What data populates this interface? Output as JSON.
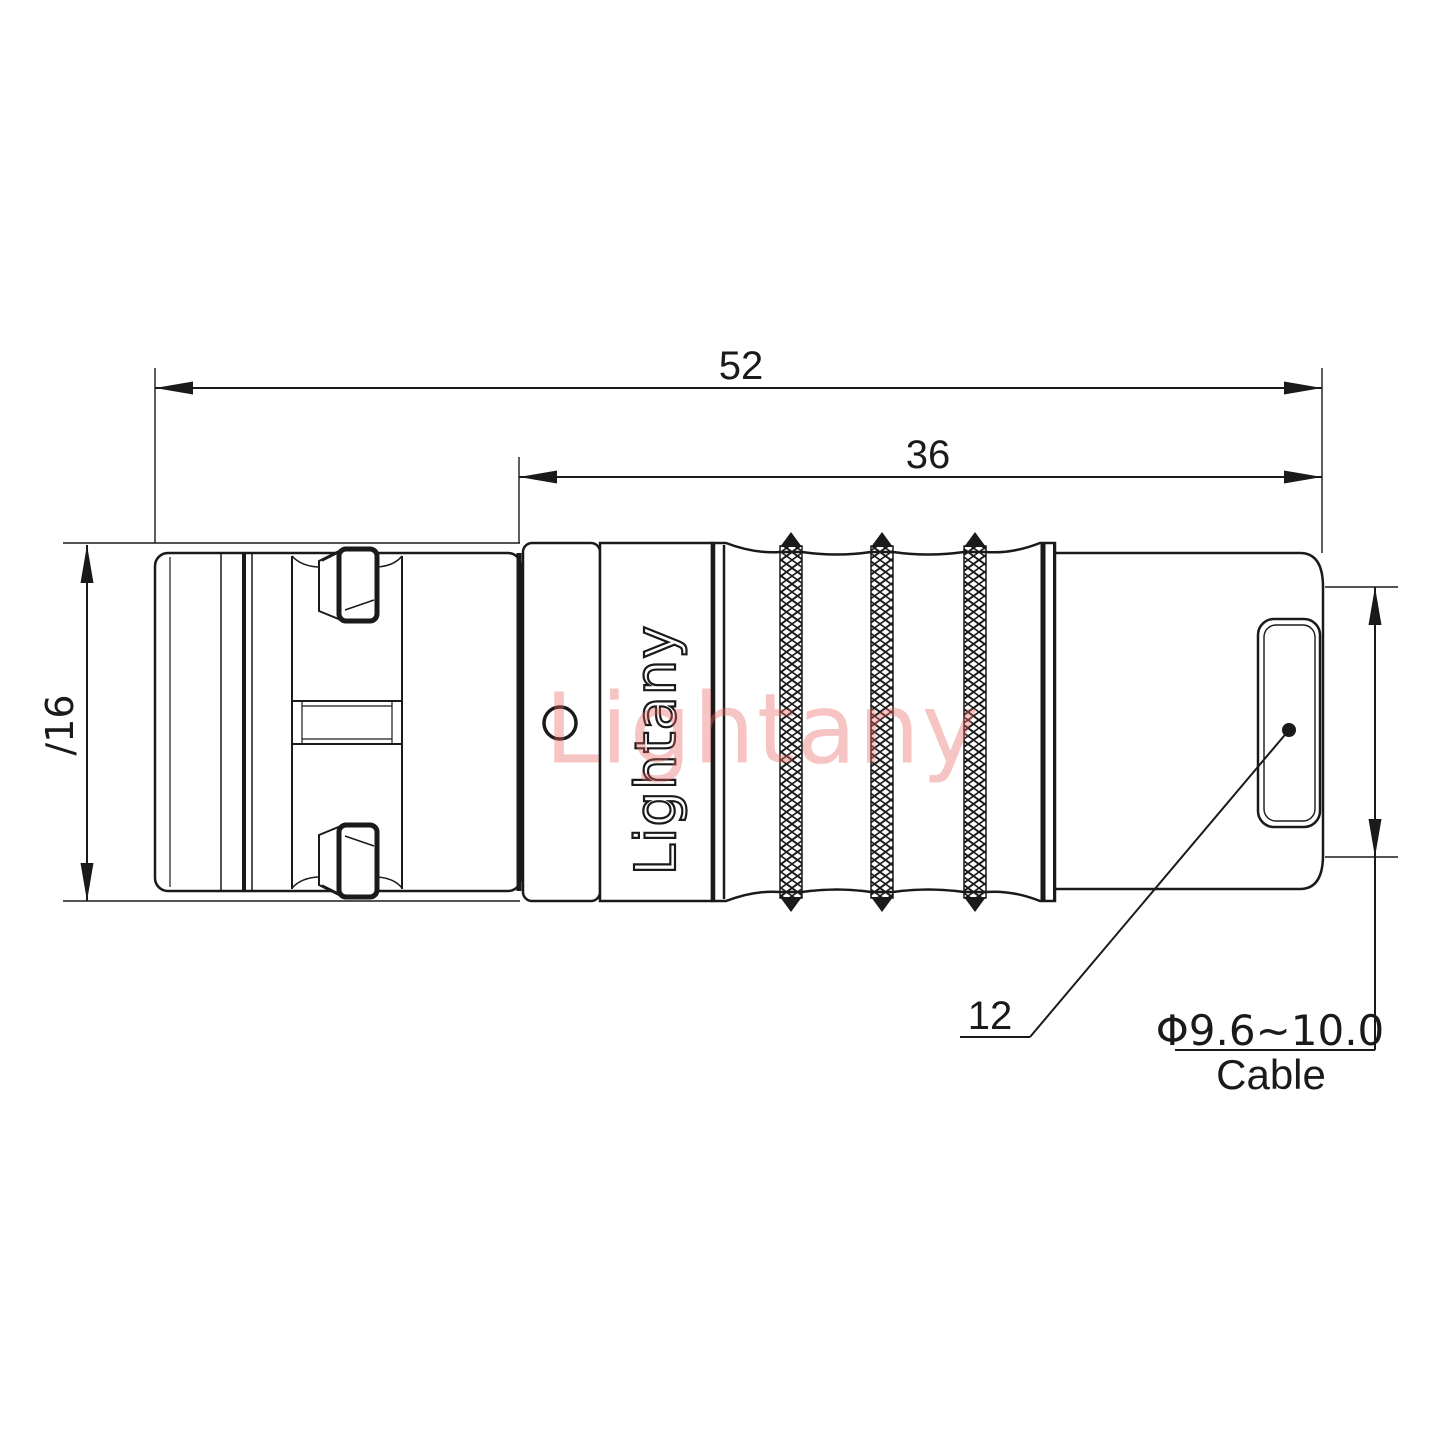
{
  "drawing": {
    "type": "engineering-drawing",
    "subject": "cable connector side view",
    "background_color": "#ffffff",
    "line_color": "#1a1a1a",
    "watermark_color": "rgba(235,100,100,0.38)"
  },
  "labels": {
    "dim_overall_length": "52",
    "dim_nut_length": "36",
    "dim_shell_diameter": "∕16",
    "dim_end_face": "12",
    "cable_diameter_range": "Φ9.6~10.0",
    "cable_word": "Cable"
  },
  "branding": {
    "engraving": "Lightany",
    "watermark": "Lightany"
  }
}
